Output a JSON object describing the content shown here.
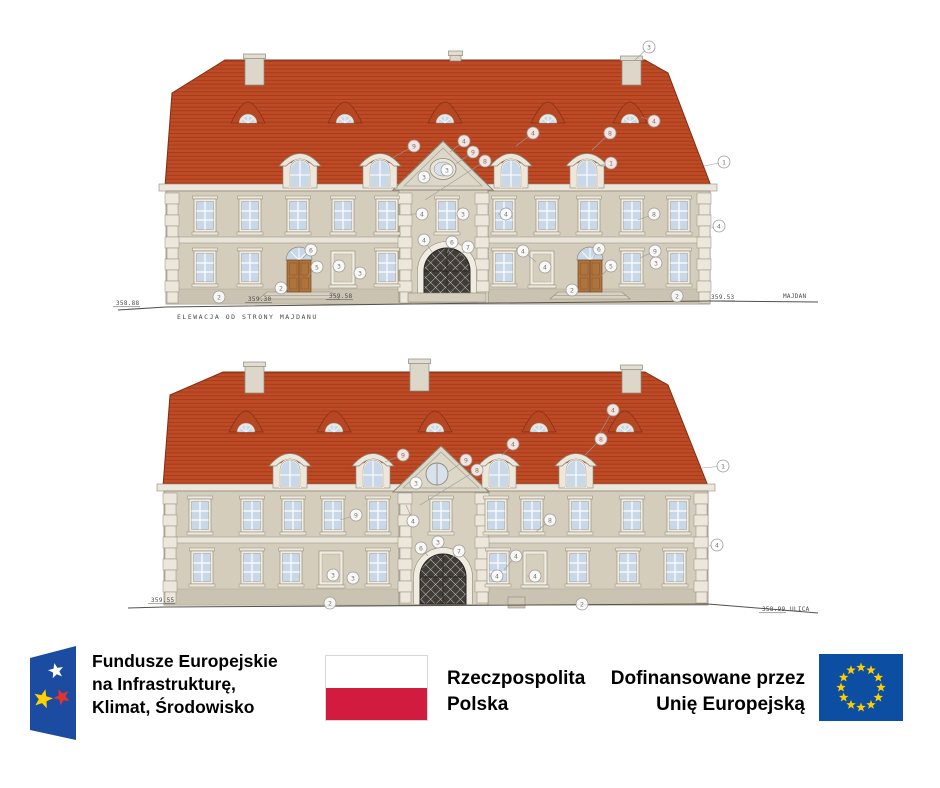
{
  "colors": {
    "roof": "#bf4b26",
    "facade": "#d5cdbc",
    "fe_blue": "#1b4ca1",
    "poland_red": "#d21c3f",
    "eu_blue": "#0b4ea2",
    "star_yellow": "#ffcc00"
  },
  "logos": {
    "fe": {
      "lines": [
        "Fundusze Europejskie",
        "na Infrastrukturę,",
        "Klimat, Środowisko"
      ]
    },
    "pl": {
      "lines": [
        "Rzeczpospolita",
        "Polska"
      ]
    },
    "eu": {
      "lines": [
        "Dofinansowane przez",
        "Unię Europejską"
      ]
    }
  },
  "drawings": [
    {
      "caption": {
        "text": "ELEWACJA OD STRONY MAJDANU",
        "x": 177,
        "y": 319
      },
      "marks": [
        {
          "text": "358.88",
          "x": 116,
          "y": 305
        },
        {
          "text": "359.30",
          "x": 248,
          "y": 301
        },
        {
          "text": "359.58",
          "x": 329,
          "y": 298
        },
        {
          "text": "359.53",
          "x": 711,
          "y": 299
        },
        {
          "text": "MAJDAN",
          "x": 783,
          "y": 298,
          "plain": true
        }
      ],
      "windows_upper": {
        "y": 199,
        "centers": [
          205,
          250,
          298,
          343,
          387,
          447,
          504,
          547,
          589,
          632,
          679
        ]
      },
      "windows_lower": {
        "y": 251,
        "wins": [
          205,
          250,
          387,
          504,
          632,
          679
        ],
        "niches": [
          343,
          542
        ],
        "doors": [
          299,
          590
        ]
      },
      "dormers": {
        "y": 139,
        "centers": [
          300,
          380,
          511,
          587
        ]
      },
      "vents": {
        "y": 100,
        "centers": [
          248,
          345,
          445,
          548,
          630
        ]
      },
      "chimneys": [
        {
          "x": 245,
          "y": 54,
          "w": 19,
          "h": 31
        },
        {
          "x": 450,
          "y": 51,
          "w": 11,
          "h": 10
        },
        {
          "x": 622,
          "y": 56,
          "w": 19,
          "h": 29
        }
      ],
      "callouts": [
        {
          "n": "3",
          "x": 649,
          "y": 47,
          "tx": 635,
          "ty": 60
        },
        {
          "n": "1",
          "x": 724,
          "y": 162,
          "tx": 704,
          "ty": 166
        },
        {
          "n": "4",
          "x": 719,
          "y": 226,
          "tx": 711,
          "ty": 228
        },
        {
          "n": "9",
          "x": 414,
          "y": 146,
          "tx": 392,
          "ty": 158
        },
        {
          "n": "4",
          "x": 464,
          "y": 141,
          "tx": 450,
          "ty": 152
        },
        {
          "n": "9",
          "x": 473,
          "y": 152,
          "tx": 456,
          "ty": 164
        },
        {
          "n": "8",
          "x": 485,
          "y": 161,
          "tx": 425,
          "ty": 200
        },
        {
          "n": "3",
          "x": 447,
          "y": 170
        },
        {
          "n": "3",
          "x": 424,
          "y": 177
        },
        {
          "n": "4",
          "x": 533,
          "y": 133,
          "tx": 516,
          "ty": 146
        },
        {
          "n": "8",
          "x": 610,
          "y": 133,
          "tx": 592,
          "ty": 150
        },
        {
          "n": "1",
          "x": 611,
          "y": 163,
          "tx": 597,
          "ty": 166
        },
        {
          "n": "4",
          "x": 654,
          "y": 121,
          "tx": 641,
          "ty": 117
        },
        {
          "n": "4",
          "x": 422,
          "y": 214,
          "tx": 411,
          "ty": 214
        },
        {
          "n": "3",
          "x": 463,
          "y": 214
        },
        {
          "n": "4",
          "x": 424,
          "y": 240,
          "tx": 432,
          "ty": 252
        },
        {
          "n": "6",
          "x": 452,
          "y": 242,
          "tx": 447,
          "ty": 253
        },
        {
          "n": "7",
          "x": 468,
          "y": 247,
          "tx": 460,
          "ty": 256
        },
        {
          "n": "6",
          "x": 311,
          "y": 250,
          "tx": 303,
          "ty": 258
        },
        {
          "n": "5",
          "x": 317,
          "y": 267,
          "tx": 308,
          "ty": 276
        },
        {
          "n": "3",
          "x": 339,
          "y": 266
        },
        {
          "n": "3",
          "x": 360,
          "y": 273
        },
        {
          "n": "2",
          "x": 281,
          "y": 288
        },
        {
          "n": "2",
          "x": 219,
          "y": 297
        },
        {
          "n": "4",
          "x": 506,
          "y": 214,
          "tx": 498,
          "ty": 214
        },
        {
          "n": "8",
          "x": 654,
          "y": 214,
          "tx": 638,
          "ty": 220
        },
        {
          "n": "4",
          "x": 523,
          "y": 251,
          "tx": 536,
          "ty": 262
        },
        {
          "n": "4",
          "x": 545,
          "y": 267
        },
        {
          "n": "6",
          "x": 599,
          "y": 249,
          "tx": 593,
          "ty": 258
        },
        {
          "n": "5",
          "x": 611,
          "y": 266,
          "tx": 601,
          "ty": 276
        },
        {
          "n": "9",
          "x": 655,
          "y": 251,
          "tx": 640,
          "ty": 258
        },
        {
          "n": "3",
          "x": 656,
          "y": 263
        },
        {
          "n": "2",
          "x": 572,
          "y": 290
        },
        {
          "n": "2",
          "x": 677,
          "y": 296
        }
      ]
    },
    {
      "caption": null,
      "marks": [
        {
          "text": "359.55",
          "x": 151,
          "y": 602
        },
        {
          "text": "358.99",
          "x": 762,
          "y": 611
        },
        {
          "text": "ULICA",
          "x": 790,
          "y": 611,
          "plain": true
        }
      ],
      "windows_upper": {
        "y": 499,
        "centers": [
          200,
          252,
          293,
          333,
          378,
          441,
          496,
          532,
          580,
          632,
          678
        ]
      },
      "windows_lower": {
        "y": 551,
        "wins": [
          202,
          252,
          291,
          378,
          498,
          578,
          628,
          675
        ],
        "niches": [
          331,
          535
        ],
        "doors": []
      },
      "dormers": {
        "y": 439,
        "centers": [
          290,
          373,
          499,
          576
        ]
      },
      "vents": {
        "y": 409,
        "centers": [
          246,
          334,
          435,
          539,
          625
        ]
      },
      "chimneys": [
        {
          "x": 245,
          "y": 362,
          "w": 19,
          "h": 31
        },
        {
          "x": 410,
          "y": 359,
          "w": 19,
          "h": 32
        },
        {
          "x": 622,
          "y": 365,
          "w": 19,
          "h": 28
        }
      ],
      "callouts": [
        {
          "n": "9",
          "x": 403,
          "y": 455,
          "tx": 385,
          "ty": 462
        },
        {
          "n": "4",
          "x": 513,
          "y": 444,
          "tx": 502,
          "ty": 455
        },
        {
          "n": "9",
          "x": 466,
          "y": 460,
          "tx": 448,
          "ty": 472
        },
        {
          "n": "8",
          "x": 477,
          "y": 470,
          "tx": 420,
          "ty": 505
        },
        {
          "n": "3",
          "x": 416,
          "y": 483
        },
        {
          "n": "4",
          "x": 613,
          "y": 410,
          "tx": 596,
          "ty": 440
        },
        {
          "n": "8",
          "x": 601,
          "y": 439,
          "tx": 585,
          "ty": 455
        },
        {
          "n": "1",
          "x": 723,
          "y": 466,
          "tx": 702,
          "ty": 468
        },
        {
          "n": "4",
          "x": 717,
          "y": 545,
          "tx": 709,
          "ty": 546
        },
        {
          "n": "4",
          "x": 413,
          "y": 521,
          "tx": 406,
          "ty": 505
        },
        {
          "n": "9",
          "x": 356,
          "y": 515,
          "tx": 340,
          "ty": 520
        },
        {
          "n": "8",
          "x": 550,
          "y": 520,
          "tx": 536,
          "ty": 532
        },
        {
          "n": "6",
          "x": 421,
          "y": 548,
          "tx": 428,
          "ty": 556
        },
        {
          "n": "3",
          "x": 438,
          "y": 542
        },
        {
          "n": "7",
          "x": 459,
          "y": 551,
          "tx": 452,
          "ty": 558
        },
        {
          "n": "4",
          "x": 516,
          "y": 556,
          "tx": 504,
          "ty": 570
        },
        {
          "n": "4",
          "x": 497,
          "y": 576,
          "tx": 489,
          "ty": 576
        },
        {
          "n": "4",
          "x": 535,
          "y": 576,
          "tx": 527,
          "ty": 576
        },
        {
          "n": "3",
          "x": 333,
          "y": 575
        },
        {
          "n": "3",
          "x": 353,
          "y": 578
        },
        {
          "n": "2",
          "x": 330,
          "y": 603
        },
        {
          "n": "2",
          "x": 582,
          "y": 604
        }
      ]
    }
  ]
}
